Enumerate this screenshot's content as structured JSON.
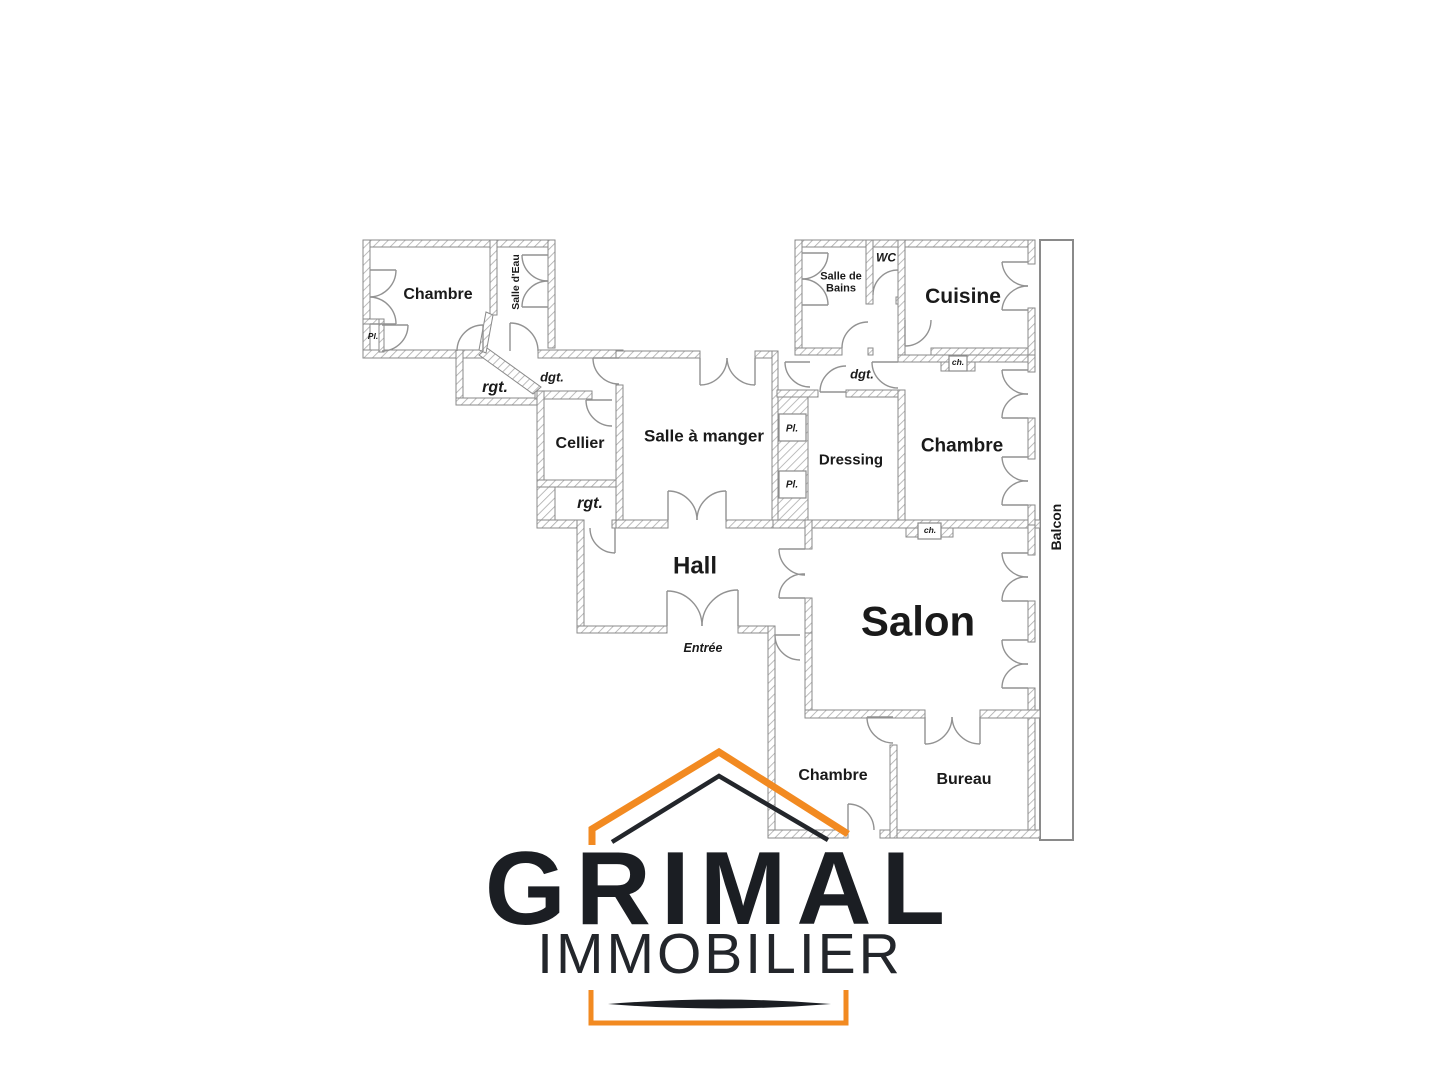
{
  "plan": {
    "rooms": [
      {
        "id": "chambre-top-left",
        "label": "Chambre"
      },
      {
        "id": "salle-d-eau",
        "label": "Salle d'Eau"
      },
      {
        "id": "placard-top-left",
        "label": "Pl."
      },
      {
        "id": "rangement-1",
        "label": "rgt."
      },
      {
        "id": "degagement-1",
        "label": "dgt."
      },
      {
        "id": "cellier",
        "label": "Cellier"
      },
      {
        "id": "rangement-2",
        "label": "rgt."
      },
      {
        "id": "salle-a-manger",
        "label": "Salle à manger"
      },
      {
        "id": "placard-1",
        "label": "Pl."
      },
      {
        "id": "placard-2",
        "label": "Pl."
      },
      {
        "id": "dressing",
        "label": "Dressing"
      },
      {
        "id": "salle-de-bains",
        "label": "Salle de Bains"
      },
      {
        "id": "wc",
        "label": "WC"
      },
      {
        "id": "cuisine",
        "label": "Cuisine"
      },
      {
        "id": "degagement-2",
        "label": "dgt."
      },
      {
        "id": "chambre-right",
        "label": "Chambre"
      },
      {
        "id": "conduit-1",
        "label": "ch."
      },
      {
        "id": "conduit-2",
        "label": "ch."
      },
      {
        "id": "hall",
        "label": "Hall"
      },
      {
        "id": "entree",
        "label": "Entrée"
      },
      {
        "id": "salon",
        "label": "Salon"
      },
      {
        "id": "balcon",
        "label": "Balcon"
      },
      {
        "id": "chambre-bottom",
        "label": "Chambre"
      },
      {
        "id": "bureau",
        "label": "Bureau"
      }
    ]
  },
  "logo": {
    "name": "GRIMAL",
    "tagline": "IMMOBILIER",
    "accent_color": "#F28A21",
    "text_color": "#1B1E23"
  }
}
